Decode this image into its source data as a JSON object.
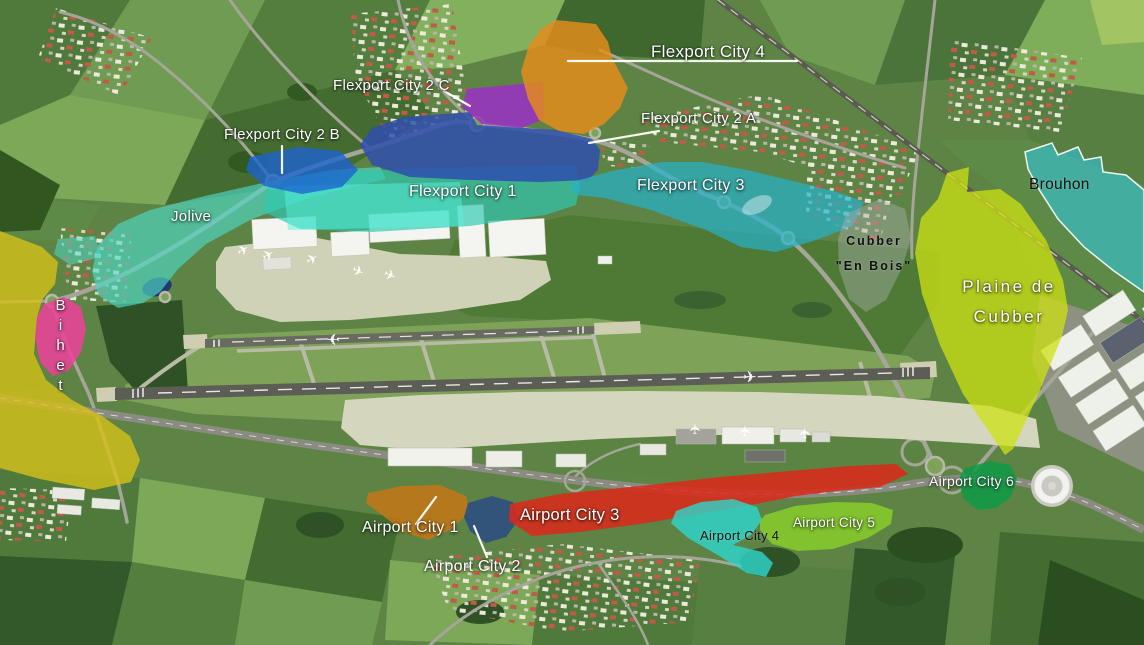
{
  "zones": {
    "flexport_city_1": {
      "label": "Flexport City 1",
      "color": "#2fc9b2",
      "highlight_color": "#55f2de"
    },
    "flexport_city_2a": {
      "label": "Flexport City 2 A",
      "color": "#2f4fae"
    },
    "flexport_city_2b": {
      "label": "Flexport City 2 B",
      "color": "#1e64d0"
    },
    "flexport_city_2c": {
      "label": "Flexport City 2 C",
      "color": "#9a2fc5"
    },
    "flexport_city_3": {
      "label": "Flexport City 3",
      "color": "#27b2cb"
    },
    "flexport_city_4": {
      "label": "Flexport City 4",
      "color": "#e68c1b"
    },
    "jolive": {
      "label": "Jolive",
      "color": "#4fd9c6"
    },
    "bihet": {
      "label": "Bihet",
      "color": "#ef3f9b"
    },
    "unlabeled_west": {
      "color": "#d9c117"
    },
    "cubber_en_bois": {
      "label_line1": "Cubber",
      "label_line2": "\"En Bois\"",
      "color": "#a8adab"
    },
    "plaine_de_cubber": {
      "label_line1": "Plaine de",
      "label_line2": "Cubber",
      "color": "#cde212"
    },
    "brouhon": {
      "label": "Brouhon",
      "color": "#32c5da"
    },
    "airport_city_1": {
      "label": "Airport City 1",
      "color": "#c67616"
    },
    "airport_city_2": {
      "label": "Airport City 2",
      "color": "#2c4d82"
    },
    "airport_city_3": {
      "label": "Airport City 3",
      "color": "#d92a1b"
    },
    "airport_city_4": {
      "label": "Airport City 4",
      "color": "#2ed7cf"
    },
    "airport_city_5": {
      "label": "Airport City 5",
      "color": "#87cd2a"
    },
    "airport_city_6": {
      "label": "Airport City 6",
      "color": "#0e9a45"
    }
  }
}
